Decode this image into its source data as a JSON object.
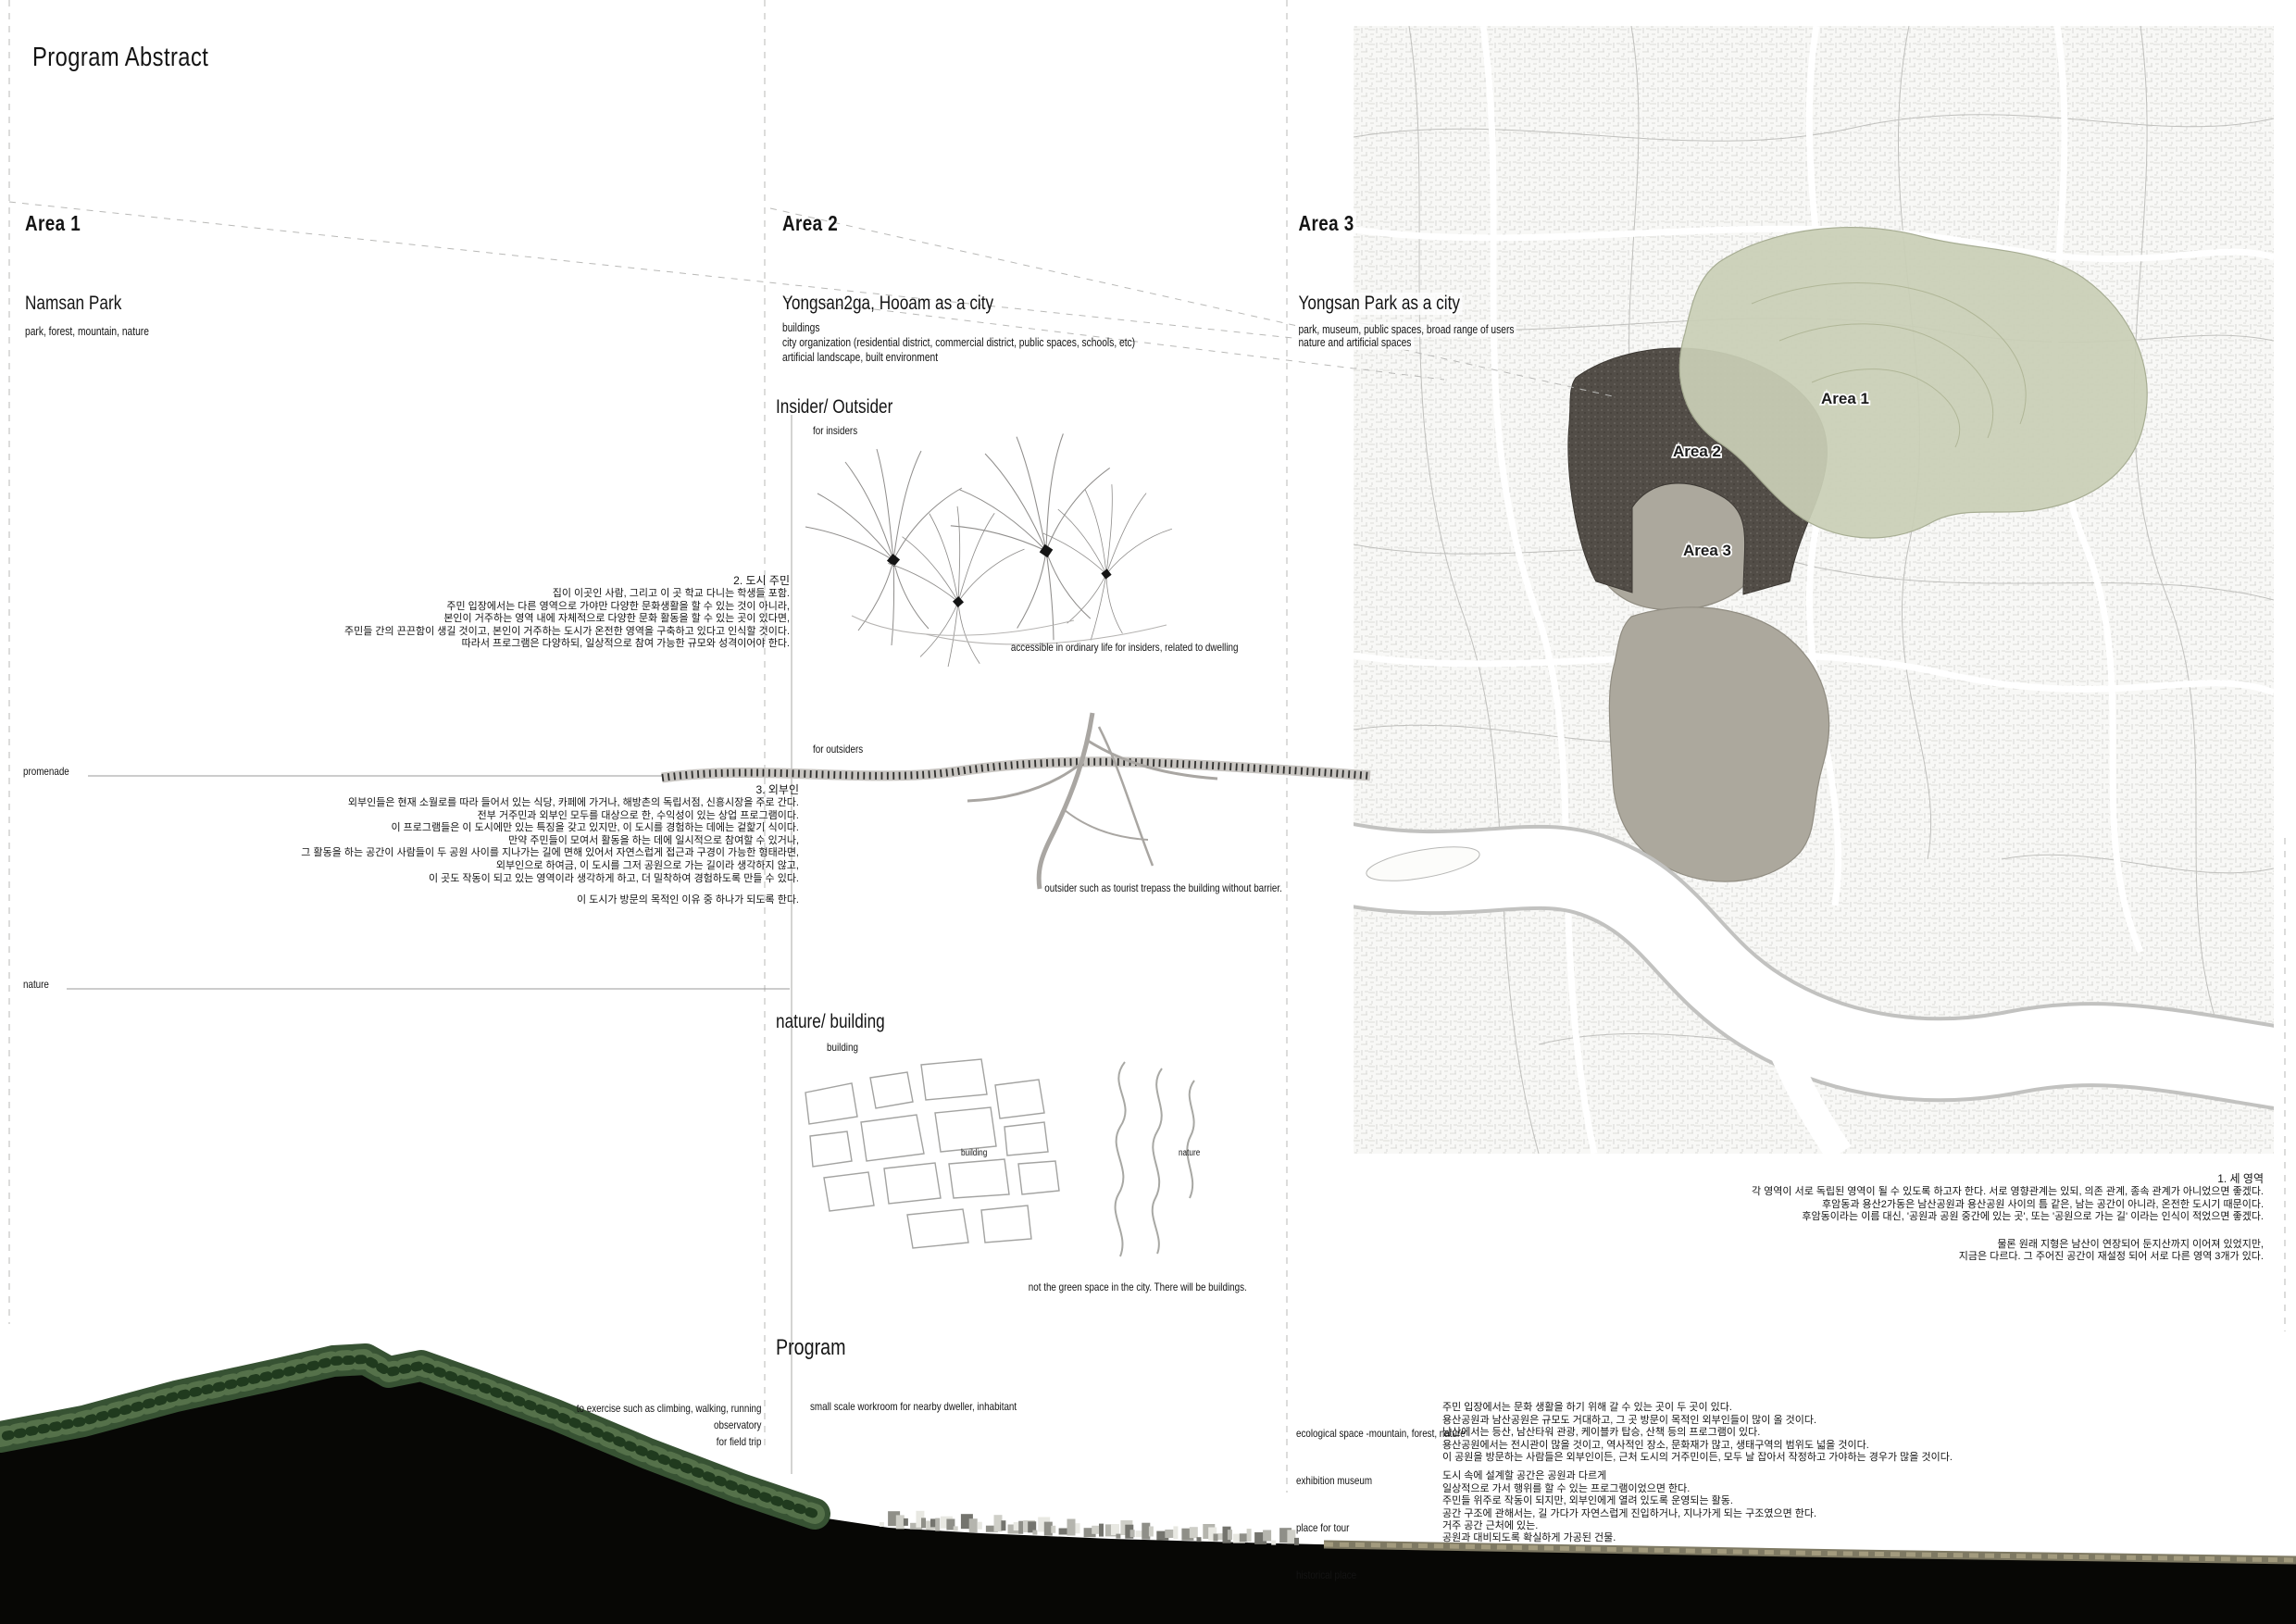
{
  "title": "Program Abstract",
  "areas": [
    {
      "heading": "Area 1",
      "name": "Namsan Park",
      "details": [
        "park, forest, mountain, nature"
      ]
    },
    {
      "heading": "Area 2",
      "name": "Yongsan2ga, Hooam as a city",
      "details": [
        "buildings",
        "city organization (residential district, commercial district, public spaces, schools, etc)",
        "artificial landscape, built environment"
      ]
    },
    {
      "heading": "Area 3",
      "name": "Yongsan Park as a city",
      "details": [
        "park, museum, public spaces, broad range of users",
        "nature and artificial spaces"
      ]
    }
  ],
  "left_labels": {
    "promenade": "promenade",
    "nature": "nature"
  },
  "insider_outsider": {
    "heading": "Insider/ Outsider",
    "for_insiders": "for insiders",
    "insiders_note": "accessible in ordinary life for insiders, related to dwelling",
    "for_outsiders": "for outsiders",
    "outsiders_note": "outsider such as tourist trepass the building without barrier."
  },
  "nature_building": {
    "heading": "nature/ building",
    "column_label": "building",
    "sketch_building_label": "building",
    "sketch_nature_label": "nature",
    "note": "not the green space in the city. There will be buildings."
  },
  "program": {
    "heading": "Program",
    "left_notes": [
      "to exercise such as climbing, walking, running",
      "observatory",
      "for field trip"
    ],
    "center_note": "small scale workroom for nearby dweller, inhabitant",
    "right_list": [
      "ecological space -mountain, forest, nature",
      "exhibition    museum",
      "place for tour",
      "historical place"
    ]
  },
  "korean": {
    "city_residents": {
      "title": "2. 도시 주민",
      "lines": [
        "집이 이곳인 사람, 그리고 이 곳 학교 다니는 학생들 포함.",
        "주민 입장에서는 다른 영역으로 가야만 다양한 문화생활을 할 수 있는 것이 아니라,",
        "본인이 거주하는 영역 내에 자체적으로 다양한 문화 활동을 할 수 있는 곳이 있다면,",
        "주민들 간의 끈끈함이 생길 것이고, 본인이 거주하는 도시가 온전한 영역을 구축하고 있다고 인식할 것이다.",
        "따라서 프로그램은 다양하되, 일상적으로 참여 가능한 규모와 성격이어야 한다."
      ]
    },
    "outsiders": {
      "title": "3. 외부인",
      "lines": [
        "외부인들은 현재 소월로를 따라 들어서 있는 식당, 카페에 가거나, 해방촌의 독립서점, 신흥시장을 주로 간다.",
        "전부 거주민과 외부인 모두를 대상으로 한, 수익성이 있는 상업 프로그램이다.",
        "이 프로그램들은 이 도시에만 있는 특징을 갖고 있지만, 이 도시를 경험하는 데에는 겉핥기 식이다.",
        "만약 주민들이 모여서 활동을 하는 데에 일시적으로 참여할 수 있거나,",
        "그 활동을 하는 공간이 사람들이 두 공원 사이를 지나가는 길에 면해 있어서 자연스럽게 접근과 구경이 가능한 형태라면,",
        "외부인으로 하여금, 이 도시를 그저 공원으로 가는 길이라 생각하지 않고,",
        "이 곳도 작동이 되고 있는 영역이라 생각하게 하고, 더 밀착하여 경험하도록 만들 수 있다."
      ],
      "closing": "이 도시가 방문의 목적인 이유 중 하나가 되도록 한다."
    },
    "three_areas": {
      "title": "1. 세 영역",
      "lines": [
        "각 영역이 서로 독립된 영역이 될 수 있도록 하고자 한다. 서로 영향관계는 있되, 의존 관계, 종속 관계가 아니었으면 좋겠다.",
        "후암동과 용산2가동은 남산공원과 용산공원 사이의 틈 같은, 남는 공간이 아니라, 온전한 도시기 때문이다.",
        "후암동이라는 이름 대신, '공원과 공원 중간에 있는 곳', 또는 '공원으로 가는 길' 이라는 인식이 적었으면 좋겠다."
      ],
      "closing_lines": [
        "물론 원래 지형은 남산이 연장되어 둔지산까지 이어져 있었지만,",
        "지금은 다르다. 그 주어진 공간이 재설정 되어 서로 다른 영역 3개가 있다."
      ]
    },
    "program_p1": {
      "lines": [
        "주민 입장에서는 문화 생활을 하기 위해 갈 수 있는 곳이 두 곳이 있다.",
        "용산공원과 남산공원은 규모도 거대하고, 그 곳 방문이 목적인 외부인들이 많이 올 것이다.",
        "남산에서는 등산, 남산타워 관광, 케이블카 탑승, 산책 등의 프로그램이 있다.",
        "용산공원에서는 전시관이 많을 것이고, 역사적인 장소, 문화재가 많고, 생태구역의 범위도 넓을 것이다.",
        "이 공원을 방문하는 사람들은 외부인이든, 근처 도시의 거주민이든, 모두 날 잡아서 작정하고 가야하는 경우가 많을 것이다."
      ]
    },
    "program_p2": {
      "lines": [
        "도시 속에 설계할 공간은 공원과 다르게",
        "일상적으로 가서 행위를 할 수 있는 프로그램이었으면 한다.",
        "주민들 위주로 작동이 되지만, 외부인에게 열려 있도록 운영되는 활동.",
        "공간 구조에 관해서는, 길 가다가 자연스럽게 진입하거나, 지나가게 되는 구조였으면 한다.",
        "거주 공간 근처에 있는."
      ]
    },
    "program_p3": {
      "line": "공원과 대비되도록 확실하게 가공된 건물."
    }
  },
  "map": {
    "labels": [
      "Area 1",
      "Area 2",
      "Area 3"
    ],
    "colors": {
      "area1_green": "#c9cfb6",
      "area2_dark": "#524d47",
      "area3_gray": "#aca89d",
      "river": "#ffffff"
    }
  }
}
